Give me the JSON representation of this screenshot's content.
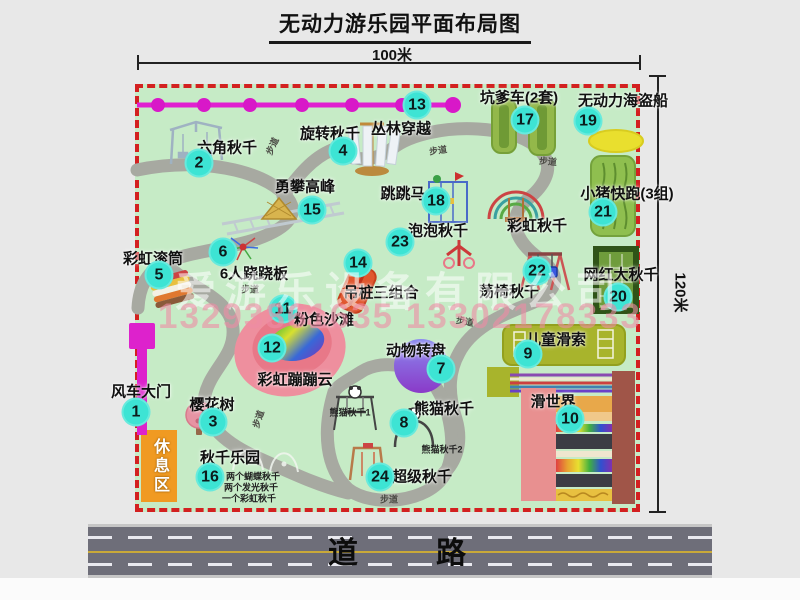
{
  "title": "无动力游乐园平面布局图",
  "dimensions": {
    "width_label": "100米",
    "height_label": "120米"
  },
  "road_label": "道　　路",
  "rest_area_label": "休息区",
  "walkway_label": "步道",
  "watermark": {
    "company": "爱游乐设备有限公司",
    "phone": "13293861635 13302178333"
  },
  "colors": {
    "map_bg": "#c6ebc6",
    "map_border": "#d32020",
    "badge": "#3de4d4",
    "zipline": "#e020d0",
    "gate": "#dd22cc",
    "rest_area": "#f09a22",
    "road": "#6e6e79",
    "walkway": "#a7a9a1",
    "pirate_ship": "#e9df2e",
    "pink_beach": "#ee8f9e"
  },
  "attractions": [
    {
      "num": "1",
      "label": "风车大门",
      "bx": 136,
      "by": 412,
      "lx": 141,
      "ly": 391
    },
    {
      "num": "2",
      "label": "六角秋千",
      "bx": 199,
      "by": 163,
      "lx": 227,
      "ly": 147
    },
    {
      "num": "3",
      "label": "樱花树",
      "bx": 213,
      "by": 422,
      "lx": 212,
      "ly": 404
    },
    {
      "num": "4",
      "label": "旋转秋千",
      "bx": 343,
      "by": 151,
      "lx": 330,
      "ly": 133
    },
    {
      "num": "5",
      "label": "彩虹滚筒",
      "bx": 159,
      "by": 275,
      "lx": 153,
      "ly": 258
    },
    {
      "num": "6",
      "label": "6人跷跷板",
      "bx": 223,
      "by": 252,
      "lx": 254,
      "ly": 273
    },
    {
      "num": "7",
      "label": "动物转盘",
      "bx": 441,
      "by": 369,
      "lx": 416,
      "ly": 350
    },
    {
      "num": "8",
      "label": "熊猫秋千",
      "bx": 404,
      "by": 423,
      "lx": 444,
      "ly": 408
    },
    {
      "num": "9",
      "label": "儿童滑索",
      "bx": 528,
      "by": 354,
      "lx": 556,
      "ly": 339
    },
    {
      "num": "10",
      "label": "滑世界",
      "bx": 570,
      "by": 419,
      "lx": 553,
      "ly": 401
    },
    {
      "num": "11",
      "label": "粉色沙滩",
      "bx": 283,
      "by": 309,
      "lx": 324,
      "ly": 319
    },
    {
      "num": "12",
      "label": "彩虹蹦蹦云",
      "bx": 272,
      "by": 348,
      "lx": 295,
      "ly": 379
    },
    {
      "num": "13",
      "label": "丛林穿越",
      "bx": 417,
      "by": 105,
      "lx": 401,
      "ly": 128
    },
    {
      "num": "14",
      "label": "吊桩三组合",
      "bx": 358,
      "by": 263,
      "lx": 381,
      "ly": 292
    },
    {
      "num": "15",
      "label": "勇攀高峰",
      "bx": 312,
      "by": 210,
      "lx": 305,
      "ly": 186
    },
    {
      "num": "16",
      "label": "秋千乐园",
      "bx": 210,
      "by": 477,
      "lx": 230,
      "ly": 457
    },
    {
      "num": "17",
      "label": "坑爹车(2套)",
      "bx": 525,
      "by": 120,
      "lx": 519,
      "ly": 97
    },
    {
      "num": "18",
      "label": "跳跳马",
      "bx": 436,
      "by": 201,
      "lx": 403,
      "ly": 193
    },
    {
      "num": "19",
      "label": "无动力海盗船",
      "bx": 588,
      "by": 121,
      "lx": 623,
      "ly": 100
    },
    {
      "num": "20",
      "label": "网红大秋千",
      "bx": 618,
      "by": 297,
      "lx": 621,
      "ly": 274
    },
    {
      "num": "21",
      "label": "小猪快跑(3组)",
      "bx": 603,
      "by": 212,
      "lx": 627,
      "ly": 193
    },
    {
      "num": "22",
      "label": "荡椅秋千",
      "bx": 537,
      "by": 271,
      "lx": 509,
      "ly": 291
    },
    {
      "num": "23",
      "label": "泡泡秋千",
      "bx": 400,
      "by": 242,
      "lx": 438,
      "ly": 230
    },
    {
      "num": "24",
      "label": "超级秋千",
      "bx": 380,
      "by": 477,
      "lx": 422,
      "ly": 476
    },
    {
      "num": null,
      "label": "彩虹秋千",
      "lx": 537,
      "ly": 225
    }
  ],
  "sub_labels": [
    {
      "text": "两个蝴蝶秋千",
      "x": 253,
      "y": 476
    },
    {
      "text": "两个发光秋千",
      "x": 251,
      "y": 487
    },
    {
      "text": "一个彩虹秋千",
      "x": 249,
      "y": 498
    },
    {
      "text": "熊猫秋千1",
      "x": 350,
      "y": 412
    },
    {
      "text": "熊猫秋千2",
      "x": 442,
      "y": 449
    }
  ],
  "walkway_labels": [
    {
      "x": 272,
      "y": 146,
      "rot": -65
    },
    {
      "x": 438,
      "y": 150,
      "rot": -8
    },
    {
      "x": 548,
      "y": 161,
      "rot": 5
    },
    {
      "x": 250,
      "y": 289,
      "rot": 0
    },
    {
      "x": 465,
      "y": 321,
      "rot": 10
    },
    {
      "x": 258,
      "y": 419,
      "rot": -72
    },
    {
      "x": 389,
      "y": 499,
      "rot": 0
    }
  ]
}
